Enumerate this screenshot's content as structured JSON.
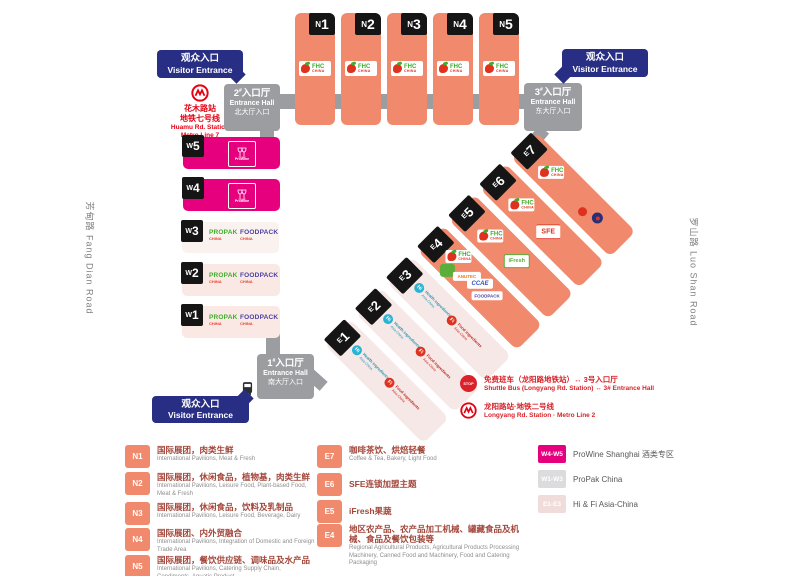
{
  "colors": {
    "salmon": "#F18A6C",
    "magenta": "#E6007E",
    "navy": "#272E83",
    "gray": "#9B9DA1",
    "metro_red": "#E60012",
    "pink_light": "#F6E8E7"
  },
  "visitor_entrance": {
    "zh": "观众入口",
    "en": "Visitor Entrance"
  },
  "entrance_halls": {
    "hash": "#",
    "unit_zh": "入口厅",
    "en": "Entrance Hall",
    "e1": {
      "no": "1",
      "gate_zh": "南大厅入口"
    },
    "e2": {
      "no": "2",
      "gate_zh": "北大厅入口"
    },
    "e3": {
      "no": "3",
      "gate_zh": "东大厅入口"
    }
  },
  "metro_huamu": {
    "station_zh": "花木路站",
    "line_zh": "地铁七号线",
    "station_en": "Huamu Rd. Station",
    "line_en": "Metro Line 7"
  },
  "shuttle": {
    "stop": "STOP",
    "zh": "免费班车（龙阳路地铁站）↔ 3号入口厅",
    "en": "Shuttle Bus (Longyang Rd. Station) ↔ 3# Entrance Hall"
  },
  "metro_longyang": {
    "zh": "龙阳路站·地铁二号线",
    "en": "Longyang Rd. Station · Metro Line 2"
  },
  "roads": {
    "west": "芳甸路 Fang Dian Road",
    "east": "罗山路 Luo Shan Road"
  },
  "halls": {
    "north": [
      {
        "letter": "N",
        "digit": "1"
      },
      {
        "letter": "N",
        "digit": "2"
      },
      {
        "letter": "N",
        "digit": "3"
      },
      {
        "letter": "N",
        "digit": "4"
      },
      {
        "letter": "N",
        "digit": "5"
      }
    ],
    "west": [
      {
        "letter": "W",
        "digit": "5"
      },
      {
        "letter": "W",
        "digit": "4"
      },
      {
        "letter": "W",
        "digit": "3"
      },
      {
        "letter": "W",
        "digit": "2"
      },
      {
        "letter": "W",
        "digit": "1"
      }
    ],
    "east": [
      {
        "letter": "E",
        "digit": "1"
      },
      {
        "letter": "E",
        "digit": "2"
      },
      {
        "letter": "E",
        "digit": "3"
      },
      {
        "letter": "E",
        "digit": "4"
      },
      {
        "letter": "E",
        "digit": "5"
      },
      {
        "letter": "E",
        "digit": "6"
      },
      {
        "letter": "E",
        "digit": "7"
      }
    ]
  },
  "logos": {
    "fhc": {
      "name": "FHC",
      "sub": "CHINA"
    },
    "prowine": "ProWine",
    "propak": {
      "name": "PROPAK",
      "sub": "CHINA"
    },
    "foodpack": {
      "name": "FOODPACK",
      "sub": "CHINA"
    },
    "sfe": "SFE",
    "ifresh": "iFresh",
    "anutec": "ANUTEC",
    "ccae": "CCAE",
    "hi": {
      "abbr": "Hi",
      "line1": "Health ingredients",
      "line2": "Asia-China"
    },
    "fi": {
      "abbr": "Fi",
      "line1": "Food ingredients",
      "line2": "Asia-China"
    }
  },
  "legend": {
    "north": [
      {
        "badge": "N1",
        "zh": "国际展团，肉类生鲜",
        "en": "International Pavilions, Meat & Fresh"
      },
      {
        "badge": "N2",
        "zh": "国际展团，休闲食品，植物基，肉类生鲜",
        "en": "International Pavilions, Leisure Food, Plant-based Food, Meat & Fresh"
      },
      {
        "badge": "N3",
        "zh": "国际展团，休闲食品，饮料及乳制品",
        "en": "International Pavilions, Leisure Food, Beverage, Dairy"
      },
      {
        "badge": "N4",
        "zh": "国际展团、内外贸融合",
        "en": "International Pavilions, Integration of Domestic and Foreign Trade Area"
      },
      {
        "badge": "N5",
        "zh": "国际展团，餐饮供应链、调味品及水产品",
        "en": "International Pavilions, Catering Supply Chain, Condiments, Aquatic Product"
      }
    ],
    "east": [
      {
        "badge": "E7",
        "zh": "咖啡茶饮、烘焙轻餐",
        "en": "Coffee & Tea, Bakery, Light Food"
      },
      {
        "badge": "E6",
        "zh": "SFE连锁加盟主题",
        "en": ""
      },
      {
        "badge": "E5",
        "zh": "iFresh果蔬",
        "en": ""
      },
      {
        "badge": "E4",
        "zh": "地区农产品、农产品加工机械、罐藏食品及机械、食品及餐饮包装等",
        "en": "Regional Agricultural Products, Agricultural Products Processing Machinery, Canned Food and Machinery, Food and Catering Packaging"
      }
    ],
    "zones": [
      {
        "badge": "W4-W5",
        "label": "ProWine Shanghai 酒类专区"
      },
      {
        "badge": "W1-W3",
        "label": "ProPak China"
      },
      {
        "badge": "E1-E3",
        "label": "Hi & Fi Asia-China"
      }
    ]
  }
}
